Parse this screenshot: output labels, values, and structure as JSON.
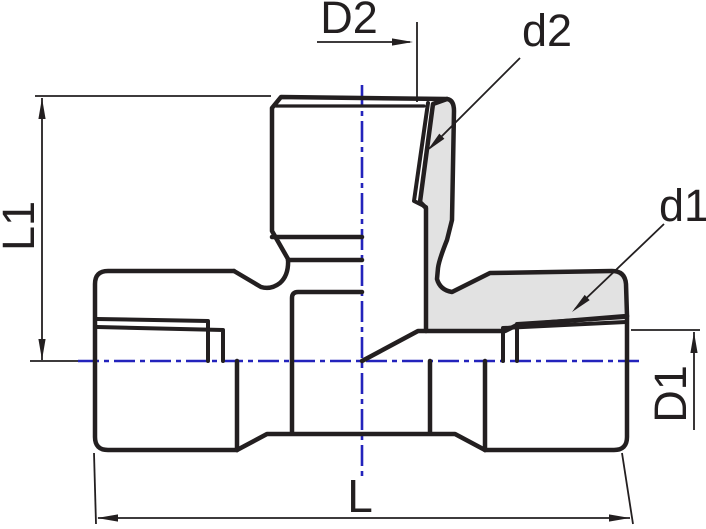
{
  "drawing": {
    "title": "tee-fitting-technical-drawing",
    "type": "pipe-tee-fitting-section-view",
    "dimensions": {
      "top_port_diameter_label": "D2",
      "top_port_thread_label": "d2",
      "right_port_thread_label": "d1",
      "branch_height_label": "L1",
      "right_port_diameter_label": "D1",
      "overall_length_label": "L"
    },
    "colors": {
      "line": "#231f20",
      "centerline_blue": "#2323bc",
      "section_fill_gray": "#e2e2e2",
      "background": "#ffffff"
    }
  }
}
